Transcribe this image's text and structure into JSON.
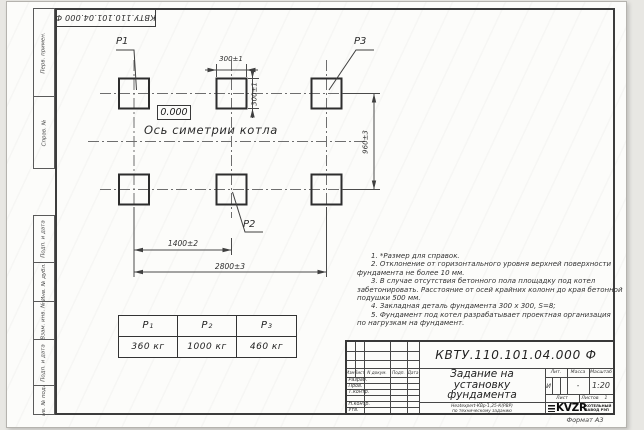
{
  "doc_number": "КВТУ.110.101.04.000 Ф",
  "side_strip": {
    "labels": [
      "Перв. примен.",
      "Справ. №",
      "Подп. и дата",
      "Инв. № дубл.",
      "Взам. инв. №",
      "Подп. и дата",
      "Инв. № подл."
    ]
  },
  "drawing": {
    "pad_labels": {
      "p1": "Р1",
      "p2": "Р2",
      "p3": "Р3"
    },
    "elevation": "0.000",
    "axis_label": "Ось симетрии котла",
    "dimensions": {
      "pad_width": "300±1",
      "pad_height": "300±1",
      "row_spacing": "960±3",
      "col_spacing": "1400±2",
      "total_span": "2800±3"
    }
  },
  "notes": {
    "lines": [
      "1. *Размер для справок.",
      "2. Отклонение от горизонтального уровня верхней поверхности",
      "фундамента не более 10 мм.",
      "3. В случае отсутствия бетонного пола площадку под котел",
      "забетонировать. Расстояние от осей крайних колонн до края бетонной",
      "подушки 500 мм.",
      "4. Закладная деталь фундамента 300 х 300, S=8;",
      "5. Фундамент под котел разрабатывает проектная организация",
      "по нагрузкам на фундамент."
    ]
  },
  "load_table": {
    "columns": [
      {
        "name": "Р",
        "sub": "1",
        "value": "360 кг"
      },
      {
        "name": "Р",
        "sub": "2",
        "value": "1000 кг"
      },
      {
        "name": "Р",
        "sub": "3",
        "value": "460 кг"
      }
    ]
  },
  "title_block": {
    "title_line1": "Задание на",
    "title_line2": "установку",
    "title_line3": "фундамента",
    "subtitle_line1": "Котел водогрейный",
    "subtitle_line2": "Heatexpert-КВр-1,25-К(РВР)",
    "subtitle_line3": "по техническому заданию",
    "rev_header": [
      "Изм.",
      "Лист",
      "N докум.",
      "Подп.",
      "Дата"
    ],
    "roles": [
      "Разраб.",
      "Пров.",
      "Т.контр.",
      "Н.контр.",
      "Утв."
    ],
    "prop_headers": [
      "Лит.",
      "Масса",
      "Масштаб"
    ],
    "lit": "И",
    "mass": "-",
    "scale": "1:20",
    "sheet_label": "Лист",
    "sheets_label": "Листов",
    "sheets_value": "1",
    "logo_text": "KVZR",
    "logo_caption_line1": "КОТЕЛЬНЫЙ",
    "logo_caption_line2": "ЗАВОД РЭП",
    "format_label": "Формат А3"
  }
}
